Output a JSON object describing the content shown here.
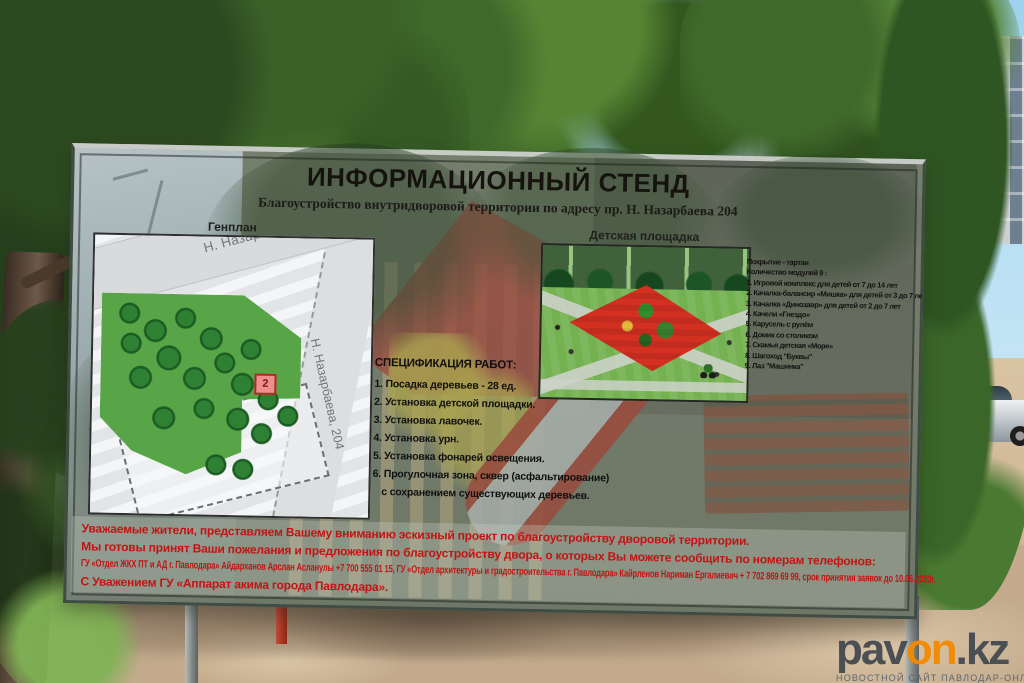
{
  "board": {
    "title": "ИНФОРМАЦИОННЫЙ СТЕНД",
    "subtitle": "Благоустройство внутридворовой территории по адресу пр. Н. Назарбаева 204",
    "genplan": {
      "label": "Генплан",
      "building_label": "Н. Назарбаева, 204",
      "street_label": "Н. Назарбаева, 204",
      "marker": "2"
    },
    "spec": {
      "heading": "СПЕЦИФИКАЦИЯ РАБОТ:",
      "items": [
        "1. Посадка деревьев - 28 ед.",
        "2. Установка детской площадки.",
        "3. Установка лавочек.",
        "4. Установка урн.",
        "5. Установка фонарей освещения.",
        "6. Прогулочная зона, сквер (асфальтирование)",
        "с сохранением существующих деревьев."
      ]
    },
    "playground": {
      "label": "Детская площадка"
    },
    "modules": {
      "coating": "Покрытие - тартан",
      "count": "Количество модулей 9 :",
      "items": [
        "1. Игровой комплекс для детей от 7 до 14 лет",
        "2. Качалка-балансир «Мишка» для детей от 3 до 7 лет",
        "3. Качалка «Динозавр» для детей от 2 до 7 лет",
        "4. Качели «Гнездо»",
        "5. Карусель с рулём",
        "6. Домик со столиком",
        "7. Скамья детская «Море»",
        "8. Шагоход \"Буквы\"",
        "9. Лаз \"Машинка\""
      ]
    },
    "notice": {
      "lines": [
        "Уважаемые жители, представляем Вашему вниманию эскизный проект по благоустройству дворовой территории.",
        "Мы готовы принят Ваши пожелания и предложения по благоустройству двора, о которых Вы можете сообщить по номерам телефонов:",
        "ГУ «Отдел ЖКХ ПТ и АД г. Павлодара» Айдарханов Арслан Асланулы  +7 700 555 01 15,  ГУ «Отдел архитектуры и градостроительства г. Павлодара» Кайрленов Нариман Ергалиевич + 7 702 869 69 99, срок принятия заявок до  10.06.2020г.",
        "С Уважением ГУ «Аппарат акима города Павлодара»."
      ]
    }
  },
  "watermark": {
    "part1": "pav",
    "part2": "on",
    "part3": ".kz",
    "tagline": "НОВОСТНОЙ САЙТ ПАВЛОДАР-ОНЛАЙН"
  },
  "colors": {
    "accent_orange": "#f28a00",
    "notice_red": "#c31313",
    "frame_green": "#3f4c44",
    "tartan_red": "#d33022"
  }
}
